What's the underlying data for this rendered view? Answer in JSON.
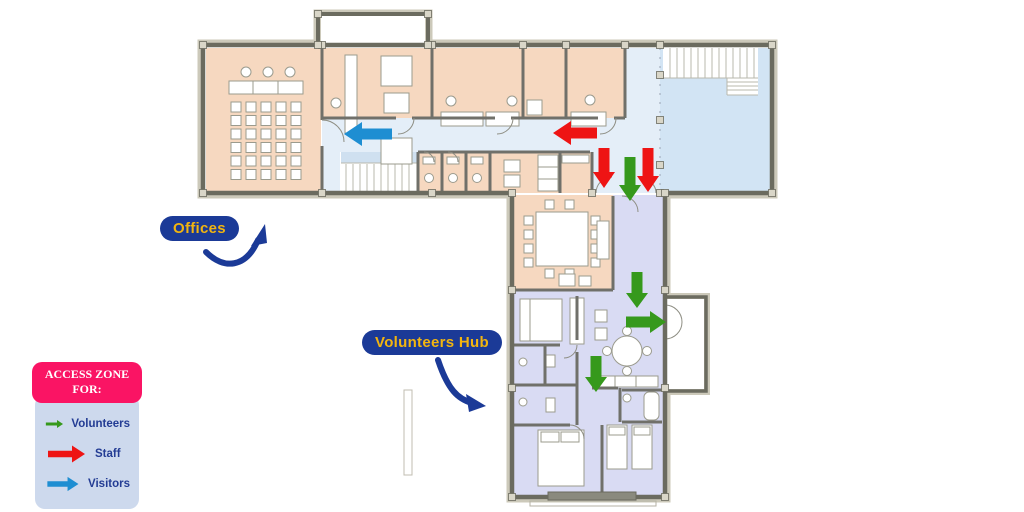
{
  "annotations": {
    "offices": "Offices",
    "volunteers_hub": "Volunteers Hub"
  },
  "legend": {
    "title_line1": "ACCESS ZONE",
    "title_line2": "FOR:",
    "items": [
      {
        "role": "volunteers",
        "label": "Volunteers"
      },
      {
        "role": "staff",
        "label": "Staff"
      },
      {
        "role": "visitors",
        "label": "Visitors"
      }
    ]
  },
  "colors": {
    "volunteers": "#36991c",
    "staff": "#ee1414",
    "visitors": "#1e8ed2",
    "badge_bg": "#1b3a97",
    "badge_text": "#f2b50f",
    "pointer": "#1b3a97",
    "legend_header_bg": "#fa1464",
    "legend_body_bg": "#cdd9ed",
    "legend_text": "#233c94",
    "zone_offices": "#f6d8c0",
    "zone_hub": "#d9dbf3",
    "zone_corridor": "#e4eef8",
    "zone_hall": "#d2e4f4",
    "wall": "#6b6b5f",
    "wall_band": "#ccc9ba",
    "furniture": "#9b9b8e",
    "stairs": "#b8b8ae"
  },
  "access_arrows": [
    {
      "role": "visitors",
      "dir": "left",
      "tip": [
        344,
        134
      ],
      "len": 48,
      "t": 11,
      "hl": 18,
      "hh": 12
    },
    {
      "role": "staff",
      "dir": "left",
      "tip": [
        553,
        133
      ],
      "len": 44,
      "t": 11,
      "hl": 18,
      "hh": 12
    },
    {
      "role": "staff",
      "dir": "down",
      "tip": [
        604,
        188
      ],
      "len": 40,
      "t": 11,
      "hl": 16,
      "hh": 11
    },
    {
      "role": "volunteers",
      "dir": "down",
      "tip": [
        630,
        201
      ],
      "len": 44,
      "t": 11,
      "hl": 16,
      "hh": 11
    },
    {
      "role": "staff",
      "dir": "down",
      "tip": [
        648,
        192
      ],
      "len": 44,
      "t": 11,
      "hl": 16,
      "hh": 11
    },
    {
      "role": "volunteers",
      "dir": "down",
      "tip": [
        637,
        308
      ],
      "len": 36,
      "t": 11,
      "hl": 15,
      "hh": 11
    },
    {
      "role": "volunteers",
      "dir": "right",
      "tip": [
        666,
        322
      ],
      "len": 40,
      "t": 11,
      "hl": 16,
      "hh": 11
    },
    {
      "role": "volunteers",
      "dir": "down",
      "tip": [
        596,
        392
      ],
      "len": 36,
      "t": 11,
      "hl": 15,
      "hh": 11
    }
  ]
}
